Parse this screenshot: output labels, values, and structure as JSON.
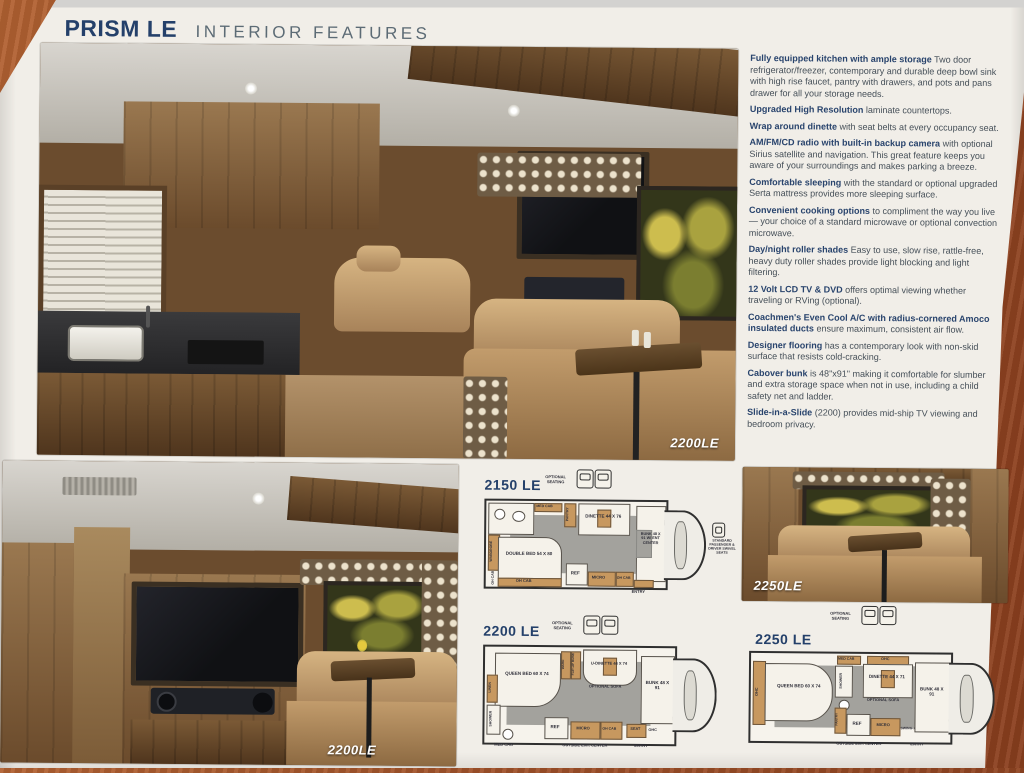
{
  "header": {
    "title": "PRISM LE",
    "subtitle": "INTERIOR FEATURES"
  },
  "colors": {
    "accent_navy": "#24406a",
    "paper": "#f1eee8",
    "desk_wood": "#a0522a",
    "caption_white": "#ffffff",
    "feature_body_text": "#454f58"
  },
  "features": [
    {
      "title": "Fully equipped kitchen with ample storage",
      "text": "Two door refrigerator/freezer, contemporary and durable deep bowl sink with high rise faucet, pantry with drawers, and pots and pans drawer for all your storage needs."
    },
    {
      "title": "Upgraded High Resolution",
      "text": "laminate countertops."
    },
    {
      "title": "Wrap around dinette",
      "text": "with seat belts at every occupancy seat."
    },
    {
      "title": "AM/FM/CD radio with built-in backup camera",
      "text": "with optional Sirius satellite and navigation. This great feature keeps you aware of your surroundings and makes parking a breeze."
    },
    {
      "title": "Comfortable sleeping",
      "text": "with the standard or optional upgraded Serta mattress provides more sleeping surface."
    },
    {
      "title": "Convenient cooking options",
      "text": "to compliment the way you live — your choice of a standard microwave or optional convection microwave."
    },
    {
      "title": "Day/night roller shades",
      "text": "Easy to use, slow rise, rattle-free, heavy duty roller shades provide light blocking and light filtering."
    },
    {
      "title": "12 Volt LCD TV & DVD",
      "text": "offers optimal viewing whether traveling or RVing (optional)."
    },
    {
      "title": "Coachmen's Even Cool A/C with radius-cornered Amoco insulated ducts",
      "text": "ensure maximum, consistent air flow."
    },
    {
      "title": "Designer flooring",
      "text": "has a contemporary look with non-skid surface that resists cold-cracking."
    },
    {
      "title": "Cabover bunk",
      "text": "is 48\"x91\" making it comfortable for slumber and extra storage space when not in use, including a child safety net and ladder."
    },
    {
      "title": "Slide-in-a-Slide",
      "text": "(2200) provides mid-ship TV viewing and bedroom privacy."
    }
  ],
  "photos": {
    "main": {
      "caption": "2200LE"
    },
    "bottom_left": {
      "caption": "2200LE"
    },
    "bottom_right": {
      "caption": "2250LE"
    }
  },
  "floorplans": {
    "p2150": {
      "name": "2150 LE",
      "labels": {
        "optional_seating": "OPTIONAL SEATING",
        "med_cab": "MED CAB",
        "wardrobe": "WARDROBE",
        "pantry": "PANTRY",
        "dinette": "DINETTE 44 X 76",
        "double_bed": "DOUBLE BED 54 X 80",
        "oh_cab_side": "OH CAB",
        "oh_cab_bottom": "OH CAB",
        "ref": "REF",
        "micro": "MICRO",
        "oh_cab2": "OH CAB",
        "bunk": "BUNK 48 X 91 W/ ENT CENTER",
        "entry": "ENTRY",
        "swivel_note": "STANDARD PASSENGER & DRIVER SWIVEL SEATS"
      }
    },
    "p2200": {
      "name": "2200 LE",
      "labels": {
        "optional_seating": "OPTIONAL SEATING",
        "ward": "WARD",
        "flip_up_bunk": "FLIP-UP BUNK",
        "u_dinette": "U-DINETTE 44 X 74",
        "optional_sofa": "OPTIONAL SOFA",
        "queen_bed": "QUEEN BED 60 X 74",
        "linen": "LINEN",
        "shower": "SHOWER",
        "med_cab": "MED CAB",
        "ref": "REF",
        "micro": "MICRO",
        "oh_cab": "OH CAB",
        "outside_ent": "OUTSIDE ENT. CENTER",
        "entry": "ENTRY",
        "seat": "SEAT",
        "ohc": "OHC",
        "bunk": "BUNK 48 X 91"
      }
    },
    "p2250": {
      "name": "2250 LE",
      "labels": {
        "optional_seating": "OPTIONAL SEATING",
        "ohc_top": "OHC",
        "med_cab": "MED CAB",
        "shower": "SHOWER",
        "dinette": "DINETTE 44 X 71",
        "optional_sofa": "OPTIONAL SOFA",
        "queen_bed": "QUEEN BED 60 X 74",
        "ohc_left": "OHC",
        "pantry": "PANTRY",
        "ref": "REF",
        "micro": "MICRO",
        "outside_ent": "OUTSIDE ENT. CENTER",
        "entry": "ENTRY",
        "swing_arm_tv": "SWING-ARM TV",
        "bunk": "BUNK 48 X 91"
      }
    }
  }
}
